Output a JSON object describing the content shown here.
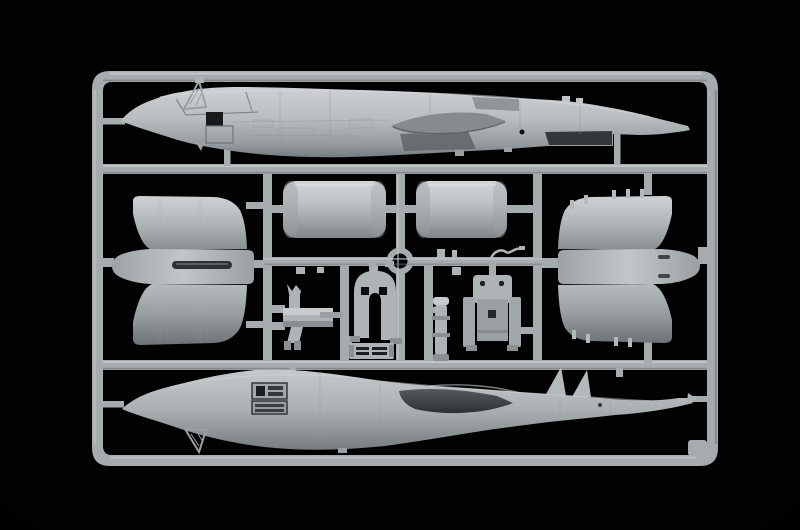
{
  "scene": {
    "description": "Photo of a light-gray plastic model kit sprue on a black background, containing two aircraft fuselage halves, two cylindrical engine nacelle halves, two winged nacelle pylon assemblies, landing gear parts, a wheel-bay arch, a grille, an actuator strut and an ejection seat.",
    "parts": [
      {
        "id": "fuselage-half-top",
        "label": "upper fuselage half, nose left"
      },
      {
        "id": "fuselage-half-bottom",
        "label": "lower fuselage half, nose left"
      },
      {
        "id": "nacelle-cylinder-left",
        "label": "engine nacelle shell"
      },
      {
        "id": "nacelle-cylinder-right",
        "label": "engine nacelle shell"
      },
      {
        "id": "nacelle-assembly-left",
        "label": "nacelle pylon assembly"
      },
      {
        "id": "nacelle-assembly-right",
        "label": "nacelle pylon assembly"
      },
      {
        "id": "landing-gear-leg",
        "label": "main landing gear"
      },
      {
        "id": "wheel-bay-arch",
        "label": "wheel bay arch"
      },
      {
        "id": "grille-part",
        "label": "vented grille"
      },
      {
        "id": "actuator-strut",
        "label": "gear strut"
      },
      {
        "id": "ejection-seat",
        "label": "ejection seat"
      },
      {
        "id": "antenna-wire",
        "label": "bent antenna"
      }
    ]
  },
  "colors": {
    "background": "#020203",
    "runner": "#a6abad",
    "runner_highlight": "#c9cdcf",
    "runner_shadow": "#73787a",
    "plastic_light": "#c7cbcd",
    "plastic_mid": "#aeb3b5",
    "plastic_shadow": "#8a9092",
    "plastic_deep": "#5d6365",
    "recess_dark": "#2e3234",
    "hole_black": "#0a0c0d"
  }
}
